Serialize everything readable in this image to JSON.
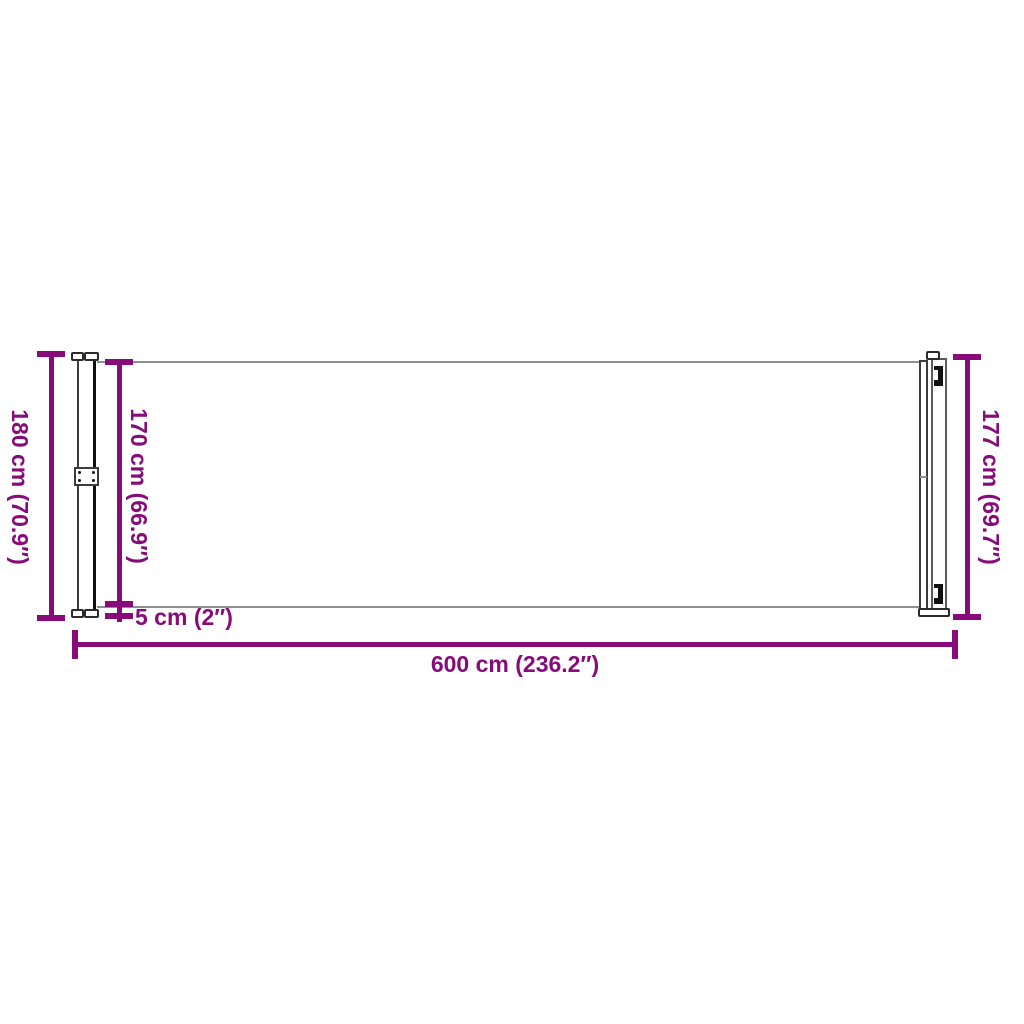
{
  "diagram": {
    "type": "product-dimension-diagram",
    "product": "retractable side awning",
    "colors": {
      "accent": "#870B78",
      "outline_gray": "#8F8F8F",
      "outline_dark": "#101010",
      "background": "#FFFFFF"
    },
    "dimensions": {
      "total_height": "180 cm (70.9″)",
      "fabric_height": "170 cm (66.9″)",
      "pole_height": "177 cm (69.7″)",
      "bottom_gap": "5 cm (2″)",
      "total_length": "600 cm (236.2″)"
    }
  }
}
